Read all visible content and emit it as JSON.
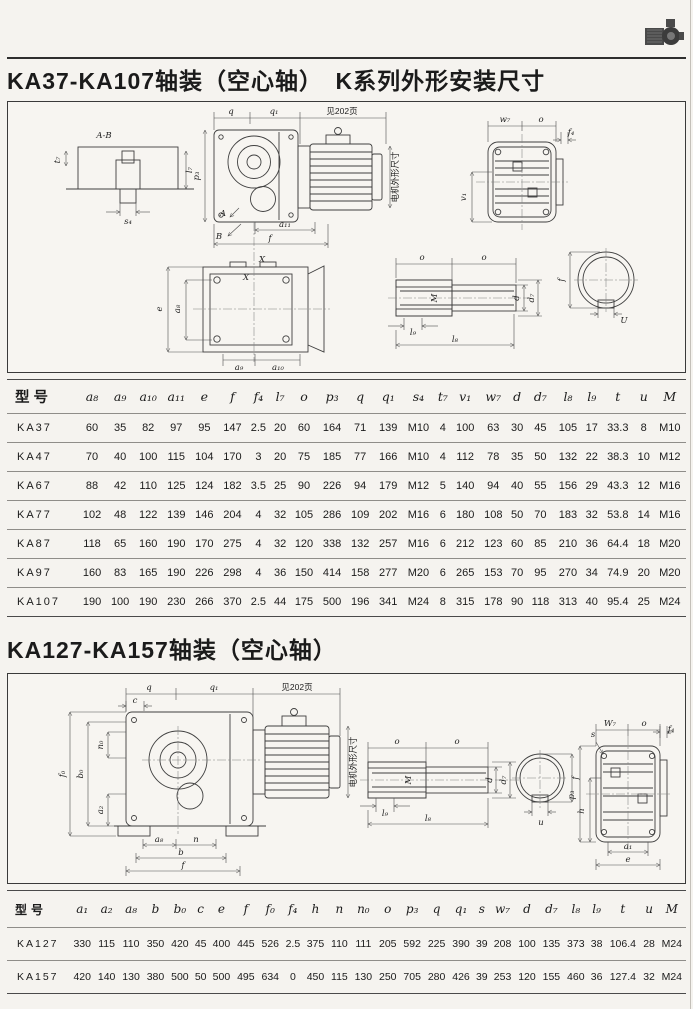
{
  "page": {
    "title1": "KA37-KA107轴装（空心轴）　K系列外形安装尺寸",
    "title2": "KA127-KA157轴装（空心轴）"
  },
  "icons": {
    "logo": "gearmotor-icon"
  },
  "drawings": {
    "box1": {
      "labels": [
        {
          "t": "A-B",
          "x": 96,
          "y": 36
        },
        {
          "t": "t₇",
          "x": 52,
          "y": 58,
          "r": -90
        },
        {
          "t": "l₇",
          "x": 184,
          "y": 68,
          "r": -90
        },
        {
          "t": "s₄",
          "x": 120,
          "y": 122
        },
        {
          "t": "q",
          "x": 223,
          "y": 12
        },
        {
          "t": "q₁",
          "x": 266,
          "y": 12
        },
        {
          "t": "见202页",
          "x": 334,
          "y": 12,
          "c": "cjk"
        },
        {
          "t": "p₃",
          "x": 191,
          "y": 74,
          "r": -90
        },
        {
          "t": "A",
          "x": 215,
          "y": 114
        },
        {
          "t": "B",
          "x": 211,
          "y": 137
        },
        {
          "t": "a₁₁",
          "x": 277,
          "y": 125
        },
        {
          "t": "f",
          "x": 262,
          "y": 139
        },
        {
          "t": "X",
          "x": 254,
          "y": 160
        },
        {
          "t": "X",
          "x": 238,
          "y": 178
        },
        {
          "t": "电机外形尺寸",
          "x": 390,
          "y": 75,
          "r": -90,
          "c": "cjk",
          "s": 6.5
        },
        {
          "t": "w₇",
          "x": 497,
          "y": 20
        },
        {
          "t": "o",
          "x": 533,
          "y": 20
        },
        {
          "t": "f₄",
          "x": 563,
          "y": 33
        },
        {
          "t": "v₁",
          "x": 458,
          "y": 95,
          "r": -90
        },
        {
          "t": "e",
          "x": 154,
          "y": 207,
          "r": -90
        },
        {
          "t": "a₈",
          "x": 172,
          "y": 207,
          "r": -90
        },
        {
          "t": "a₉",
          "x": 231,
          "y": 268
        },
        {
          "t": "a₁₀",
          "x": 270,
          "y": 268
        },
        {
          "t": "o",
          "x": 414,
          "y": 158
        },
        {
          "t": "o",
          "x": 476,
          "y": 158
        },
        {
          "t": "M",
          "x": 429,
          "y": 196,
          "r": -90
        },
        {
          "t": "d",
          "x": 511,
          "y": 196,
          "r": -90
        },
        {
          "t": "d₇",
          "x": 526,
          "y": 196,
          "r": -90
        },
        {
          "t": "l₉",
          "x": 405,
          "y": 233
        },
        {
          "t": "l₈",
          "x": 447,
          "y": 240
        },
        {
          "t": "f",
          "x": 556,
          "y": 178,
          "r": -90
        },
        {
          "t": "U",
          "x": 616,
          "y": 221
        }
      ]
    },
    "box2": {
      "labels": [
        {
          "t": "q",
          "x": 141,
          "y": 16
        },
        {
          "t": "q₁",
          "x": 206,
          "y": 16
        },
        {
          "t": "见202页",
          "x": 289,
          "y": 16,
          "c": "cjk"
        },
        {
          "t": "c",
          "x": 127,
          "y": 29
        },
        {
          "t": "n₀",
          "x": 95,
          "y": 71,
          "r": -90
        },
        {
          "t": "f₀",
          "x": 57,
          "y": 100,
          "r": -90
        },
        {
          "t": "b₀",
          "x": 75,
          "y": 100,
          "r": -90
        },
        {
          "t": "a₂",
          "x": 95,
          "y": 136,
          "r": -90
        },
        {
          "t": "a₈",
          "x": 151,
          "y": 168
        },
        {
          "t": "n",
          "x": 188,
          "y": 168
        },
        {
          "t": "b",
          "x": 173,
          "y": 181
        },
        {
          "t": "f",
          "x": 175,
          "y": 194
        },
        {
          "t": "电机外形尺寸",
          "x": 348,
          "y": 88,
          "r": -90,
          "c": "cjk",
          "s": 6.5
        },
        {
          "t": "o",
          "x": 389,
          "y": 70
        },
        {
          "t": "o",
          "x": 449,
          "y": 70
        },
        {
          "t": "M",
          "x": 403,
          "y": 106,
          "r": -90
        },
        {
          "t": "d",
          "x": 484,
          "y": 106,
          "r": -90
        },
        {
          "t": "d₇",
          "x": 498,
          "y": 106,
          "r": -90
        },
        {
          "t": "l₉",
          "x": 377,
          "y": 142
        },
        {
          "t": "l₈",
          "x": 420,
          "y": 147
        },
        {
          "t": "f",
          "x": 570,
          "y": 104,
          "r": -90
        },
        {
          "t": "u",
          "x": 533,
          "y": 151
        },
        {
          "t": "W₇",
          "x": 602,
          "y": 52
        },
        {
          "t": "o",
          "x": 636,
          "y": 52
        },
        {
          "t": "s",
          "x": 585,
          "y": 63
        },
        {
          "t": "f₄",
          "x": 663,
          "y": 58
        },
        {
          "t": "p₃",
          "x": 566,
          "y": 121,
          "r": -90
        },
        {
          "t": "h",
          "x": 576,
          "y": 137,
          "r": -90
        },
        {
          "t": "a₁",
          "x": 620,
          "y": 175
        },
        {
          "t": "e",
          "x": 620,
          "y": 188
        }
      ]
    }
  },
  "table1": {
    "headers": [
      "型号",
      "a₈",
      "a₉",
      "a₁₀",
      "a₁₁",
      "e",
      "f",
      "f₄",
      "l₇",
      "o",
      "p₃",
      "q",
      "q₁",
      "s₄",
      "t₇",
      "v₁",
      "w₇",
      "d",
      "d₇",
      "l₈",
      "l₉",
      "t",
      "u",
      "M"
    ],
    "rows": [
      [
        "KA37",
        "60",
        "35",
        "82",
        "97",
        "95",
        "147",
        "2.5",
        "20",
        "60",
        "164",
        "71",
        "139",
        "M10",
        "4",
        "100",
        "63",
        "30",
        "45",
        "105",
        "17",
        "33.3",
        "8",
        "M10"
      ],
      [
        "KA47",
        "70",
        "40",
        "100",
        "115",
        "104",
        "170",
        "3",
        "20",
        "75",
        "185",
        "77",
        "166",
        "M10",
        "4",
        "112",
        "78",
        "35",
        "50",
        "132",
        "22",
        "38.3",
        "10",
        "M12"
      ],
      [
        "KA67",
        "88",
        "42",
        "110",
        "125",
        "124",
        "182",
        "3.5",
        "25",
        "90",
        "226",
        "94",
        "179",
        "M12",
        "5",
        "140",
        "94",
        "40",
        "55",
        "156",
        "29",
        "43.3",
        "12",
        "M16"
      ],
      [
        "KA77",
        "102",
        "48",
        "122",
        "139",
        "146",
        "204",
        "4",
        "32",
        "105",
        "286",
        "109",
        "202",
        "M16",
        "6",
        "180",
        "108",
        "50",
        "70",
        "183",
        "32",
        "53.8",
        "14",
        "M16"
      ],
      [
        "KA87",
        "118",
        "65",
        "160",
        "190",
        "170",
        "275",
        "4",
        "32",
        "120",
        "338",
        "132",
        "257",
        "M16",
        "6",
        "212",
        "123",
        "60",
        "85",
        "210",
        "36",
        "64.4",
        "18",
        "M20"
      ],
      [
        "KA97",
        "160",
        "83",
        "165",
        "190",
        "226",
        "298",
        "4",
        "36",
        "150",
        "414",
        "158",
        "277",
        "M20",
        "6",
        "265",
        "153",
        "70",
        "95",
        "270",
        "34",
        "74.9",
        "20",
        "M20"
      ],
      [
        "KA107",
        "190",
        "100",
        "190",
        "230",
        "266",
        "370",
        "2.5",
        "44",
        "175",
        "500",
        "196",
        "341",
        "M24",
        "8",
        "315",
        "178",
        "90",
        "118",
        "313",
        "40",
        "95.4",
        "25",
        "M24"
      ]
    ]
  },
  "table2": {
    "headers": [
      "型号",
      "a₁",
      "a₂",
      "a₈",
      "b",
      "b₀",
      "c",
      "e",
      "f",
      "f₀",
      "f₄",
      "h",
      "n",
      "n₀",
      "o",
      "p₃",
      "q",
      "q₁",
      "s",
      "w₇",
      "d",
      "d₇",
      "l₈",
      "l₉",
      "t",
      "u",
      "M"
    ],
    "rows": [
      [
        "KA127",
        "330",
        "115",
        "110",
        "350",
        "420",
        "45",
        "400",
        "445",
        "526",
        "2.5",
        "375",
        "110",
        "111",
        "205",
        "592",
        "225",
        "390",
        "39",
        "208",
        "100",
        "135",
        "373",
        "38",
        "106.4",
        "28",
        "M24"
      ],
      [
        "KA157",
        "420",
        "140",
        "130",
        "380",
        "500",
        "50",
        "500",
        "495",
        "634",
        "0",
        "450",
        "115",
        "130",
        "250",
        "705",
        "280",
        "426",
        "39",
        "253",
        "120",
        "155",
        "460",
        "36",
        "127.4",
        "32",
        "M24"
      ]
    ]
  }
}
